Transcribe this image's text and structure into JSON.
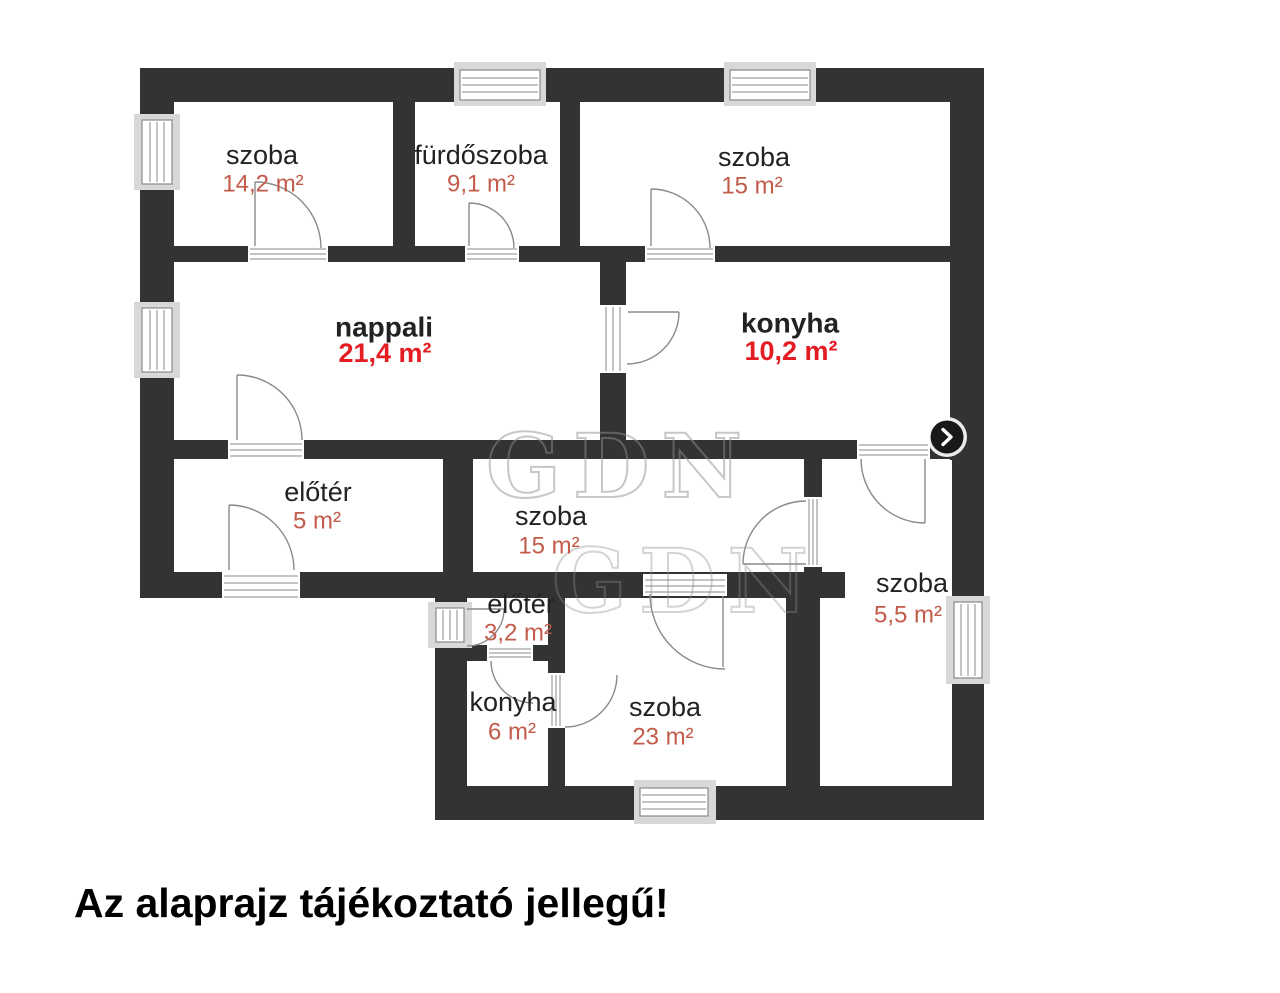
{
  "plan": {
    "rooms": [
      {
        "name": "szoba",
        "area": "14,2 m²",
        "style": "regular"
      },
      {
        "name": "fürdőszoba",
        "area": "9,1 m²",
        "style": "regular"
      },
      {
        "name": "szoba",
        "area": "15 m²",
        "style": "regular"
      },
      {
        "name": "nappali",
        "area": "21,4 m²",
        "style": "bold"
      },
      {
        "name": "konyha",
        "area": "10,2 m²",
        "style": "bold"
      },
      {
        "name": "előtér",
        "area": "5 m²",
        "style": "regular"
      },
      {
        "name": "szoba",
        "area": "15 m²",
        "style": "regular"
      },
      {
        "name": "szoba",
        "area": "5,5 m²",
        "style": "regular"
      },
      {
        "name": "előtér",
        "area": "3,2 m²",
        "style": "regular"
      },
      {
        "name": "konyha",
        "area": "6 m²",
        "style": "regular"
      },
      {
        "name": "szoba",
        "area": "23 m²",
        "style": "regular"
      }
    ],
    "watermark": "GDN",
    "disclaimer": "Az alaprajz tájékoztató jellegű!"
  },
  "controls": {
    "next_button_icon": "chevron-right"
  },
  "colors": {
    "wall": "#333333",
    "label": "#222222",
    "area_regular": "#c25b49",
    "area_bold": "#e41d23"
  }
}
